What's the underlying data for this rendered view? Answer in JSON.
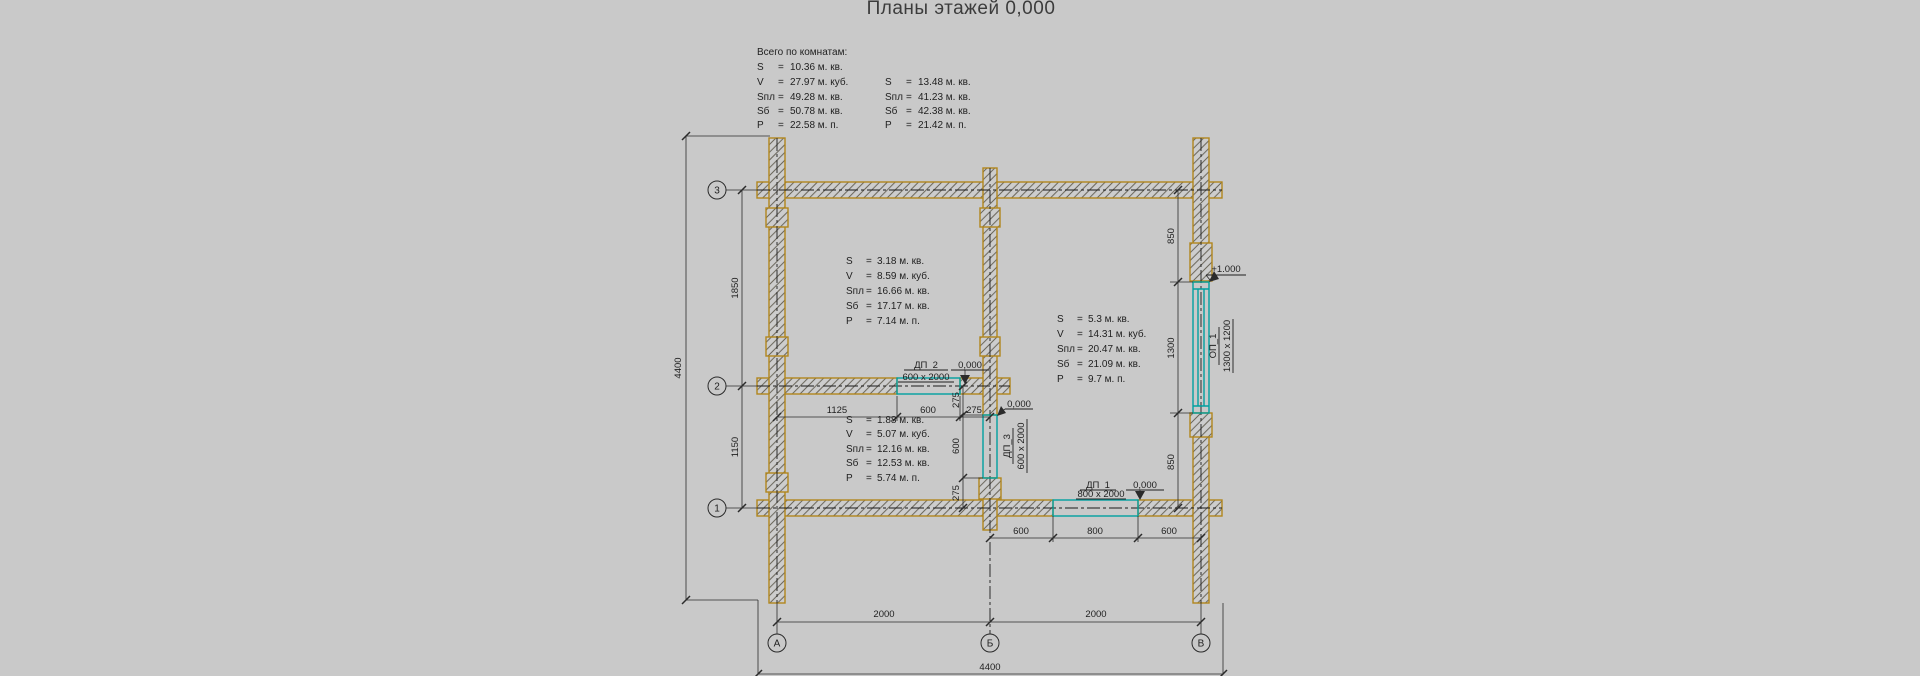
{
  "title": "Планы этажей 0,000",
  "sym": {
    "eq": "="
  },
  "summary": {
    "heading": "Всего по комнатам:",
    "block1": {
      "rows": [
        {
          "k": "S",
          "v": "10.36 м. кв."
        },
        {
          "k": "V",
          "v": "27.97 м. куб."
        },
        {
          "k": "Sпл",
          "v": "49.28 м. кв."
        },
        {
          "k": "Sб",
          "v": "50.78 м. кв."
        },
        {
          "k": "P",
          "v": "22.58 м. п."
        }
      ]
    },
    "block2": {
      "rows": [
        {
          "k": "S",
          "v": "13.48 м. кв."
        },
        {
          "k": "Sпл",
          "v": "41.23 м. кв."
        },
        {
          "k": "Sб",
          "v": "42.38 м. кв."
        },
        {
          "k": "P",
          "v": "21.42 м. п."
        }
      ]
    }
  },
  "rooms": [
    {
      "name": "room-top-left",
      "rows": [
        {
          "k": "S",
          "v": "3.18 м. кв."
        },
        {
          "k": "V",
          "v": "8.59 м. куб."
        },
        {
          "k": "Sпл",
          "v": "16.66 м. кв."
        },
        {
          "k": "Sб",
          "v": "17.17 м. кв."
        },
        {
          "k": "P",
          "v": "7.14 м. п."
        }
      ]
    },
    {
      "name": "room-bottom-left",
      "rows": [
        {
          "k": "S",
          "v": "1.88 м. кв."
        },
        {
          "k": "V",
          "v": "5.07 м. куб."
        },
        {
          "k": "Sпл",
          "v": "12.16 м. кв."
        },
        {
          "k": "Sб",
          "v": "12.53 м. кв."
        },
        {
          "k": "P",
          "v": "5.74 м. п."
        }
      ]
    },
    {
      "name": "room-right",
      "rows": [
        {
          "k": "S",
          "v": "5.3 м. кв."
        },
        {
          "k": "V",
          "v": "14.31 м. куб."
        },
        {
          "k": "Sпл",
          "v": "20.47 м. кв."
        },
        {
          "k": "Sб",
          "v": "21.09 м. кв."
        },
        {
          "k": "P",
          "v": "9.7 м. п."
        }
      ]
    }
  ],
  "openings": {
    "dp2": {
      "tag": "ДП_2",
      "size": "600 x 2000",
      "level": "0,000"
    },
    "dp3": {
      "tag": "ДП_3",
      "size": "600 x 2000",
      "level": "0,000"
    },
    "dp1": {
      "tag": "ДП_1",
      "size": "800 x 2000",
      "level": "0,000"
    },
    "op1": {
      "tag": "ОП_1",
      "size": "1300 x 1200",
      "level": "+1.000"
    }
  },
  "axes": {
    "rows": [
      "3",
      "2",
      "1"
    ],
    "cols": [
      "А",
      "Б",
      "В"
    ]
  },
  "dims": {
    "left_total": "4400",
    "left_top": "1850",
    "left_bottom": "1150",
    "right_top": "850",
    "right_mid": "1300",
    "right_bottom": "850",
    "bottom_left": "2000",
    "bottom_right": "2000",
    "bottom_total": "4400",
    "dp2_line": [
      "1125",
      "600",
      "275"
    ],
    "dp3_line": [
      "275",
      "600",
      "275"
    ],
    "dp1_line": [
      "600",
      "800",
      "600"
    ]
  },
  "colors": {
    "wall_outline": "#b1861c",
    "opening": "#00a0a0",
    "background": "#c9c9c9",
    "ink": "#1f1f1f"
  }
}
